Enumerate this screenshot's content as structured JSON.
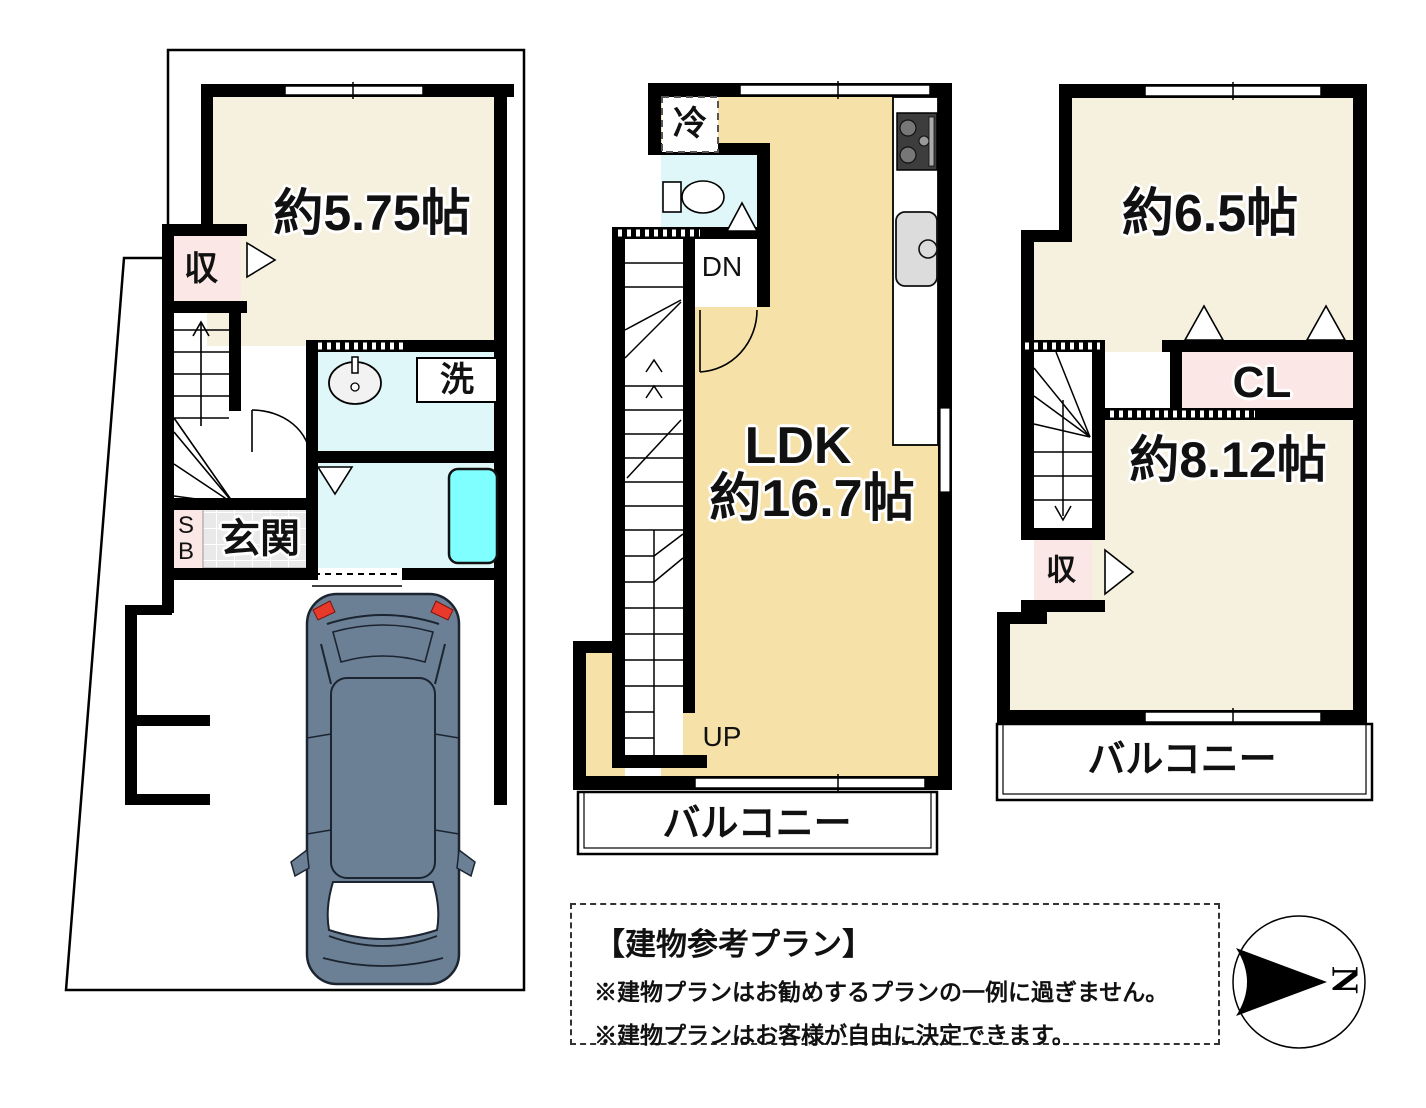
{
  "colors": {
    "wall": "#000000",
    "cream": "#F6F0DE",
    "tan": "#F6E2A8",
    "pink": "#FBE8E6",
    "cyan": "#DFF7F8",
    "tub": "#7FFFFF",
    "tile": "#E9E9E9",
    "car": "#6C8095",
    "red": "#E8392B"
  },
  "floor1": {
    "bedroom": "約5.75帖",
    "storage": "収",
    "laundry": "洗",
    "shoebox_top": "S",
    "shoebox_bottom": "B",
    "entrance": "玄関"
  },
  "floor2": {
    "fridge": "冷",
    "down": "DN",
    "ldk": "LDK",
    "ldk_size": "約16.7帖",
    "up": "UP",
    "balcony": "バルコニー"
  },
  "floor3": {
    "bedroom1": "約6.5帖",
    "closet": "CL",
    "storage": "収",
    "bedroom2": "約8.12帖",
    "balcony": "バルコニー"
  },
  "note": {
    "title": "【建物参考プラン】",
    "line1": "※建物プランはお勧めするプランの一例に過ぎません。",
    "line2": "※建物プランはお客様が自由に決定できます。"
  },
  "compass": {
    "north": "N"
  }
}
